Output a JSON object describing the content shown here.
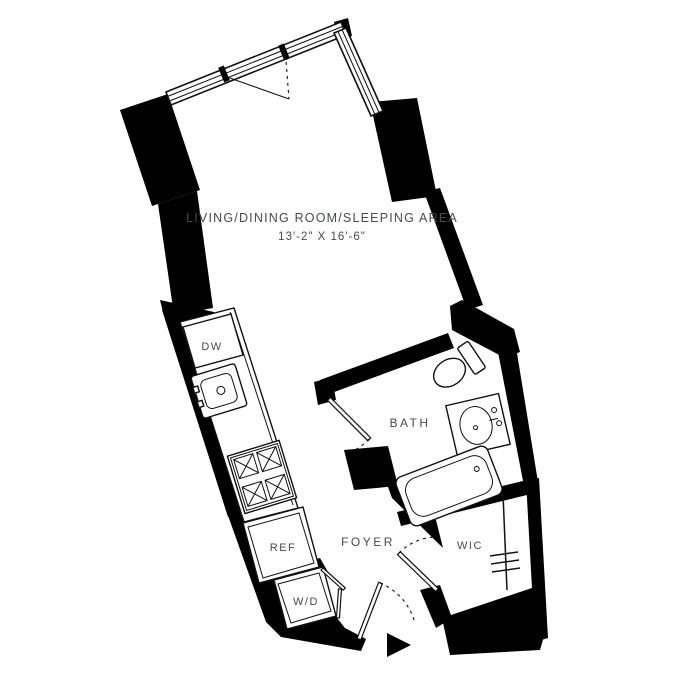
{
  "plan": {
    "title": "studio-apartment-floor-plan",
    "rooms": {
      "living": {
        "label": "LIVING/DINING ROOM/SLEEPING AREA",
        "dimensions": "13'-2\" X 16'-6\""
      },
      "bath": {
        "label": "BATH"
      },
      "foyer": {
        "label": "FOYER"
      },
      "wic": {
        "label": "WIC"
      }
    },
    "appliances": {
      "dishwasher": {
        "label": "DW"
      },
      "refrigerator": {
        "label": "REF"
      },
      "washer_dryer": {
        "label": "W/D"
      }
    },
    "symbols": {
      "entry_arrow": "black-triangle-entry-marker",
      "closet_rod": "line-with-three-hash-marks",
      "door_swings": "dashed-quarter-arcs",
      "casement_window": "triangle-swing-indicator"
    },
    "colors": {
      "wall": "#000000",
      "text": "#454b4f",
      "line": "#111111",
      "background": "#ffffff"
    }
  }
}
